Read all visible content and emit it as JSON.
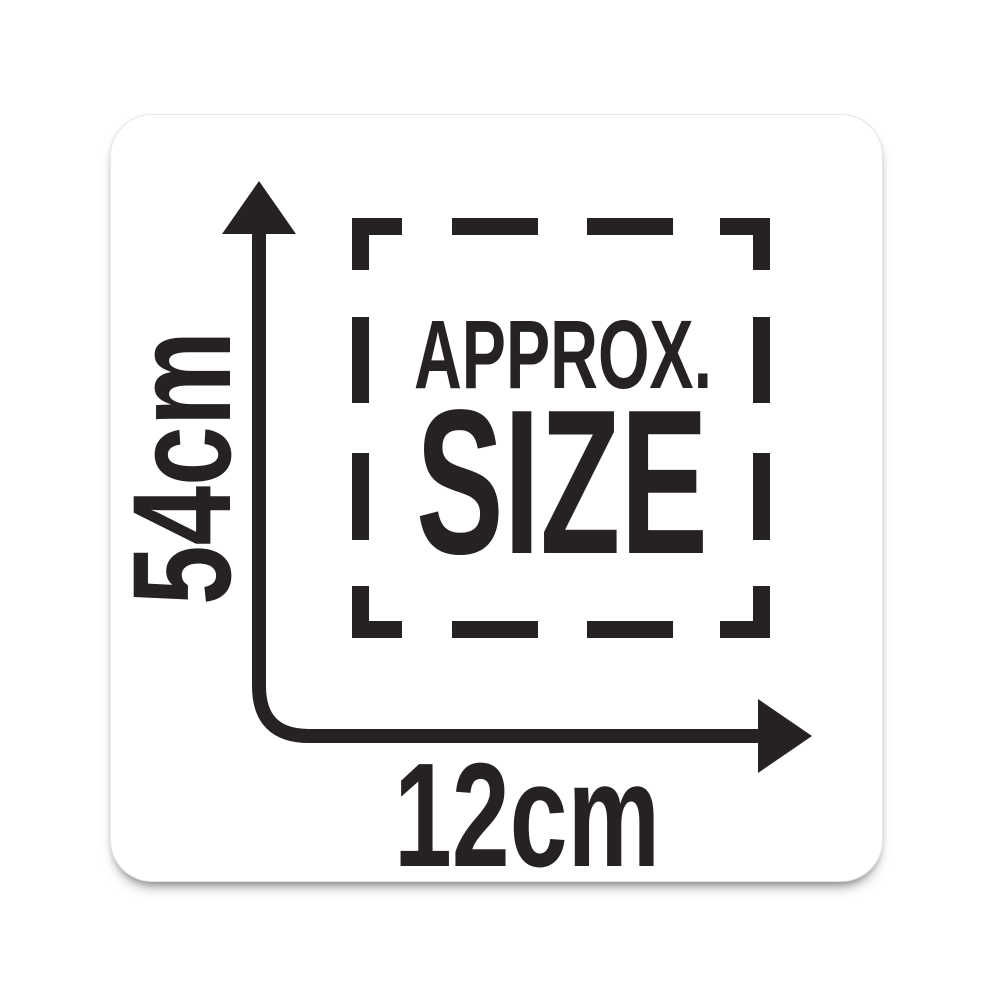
{
  "card": {
    "approx_label": "APPROX.",
    "size_label": "SIZE",
    "height_value": "54cm",
    "width_value": "12cm"
  },
  "icons": {
    "dimension_arrow": "l-shaped-up-and-right-measurement-arrow",
    "dashed_outline": "dashed-square-outline"
  },
  "colors": {
    "ink": "#262223",
    "card_background": "#ffffff",
    "page_background": "#ffffff"
  }
}
